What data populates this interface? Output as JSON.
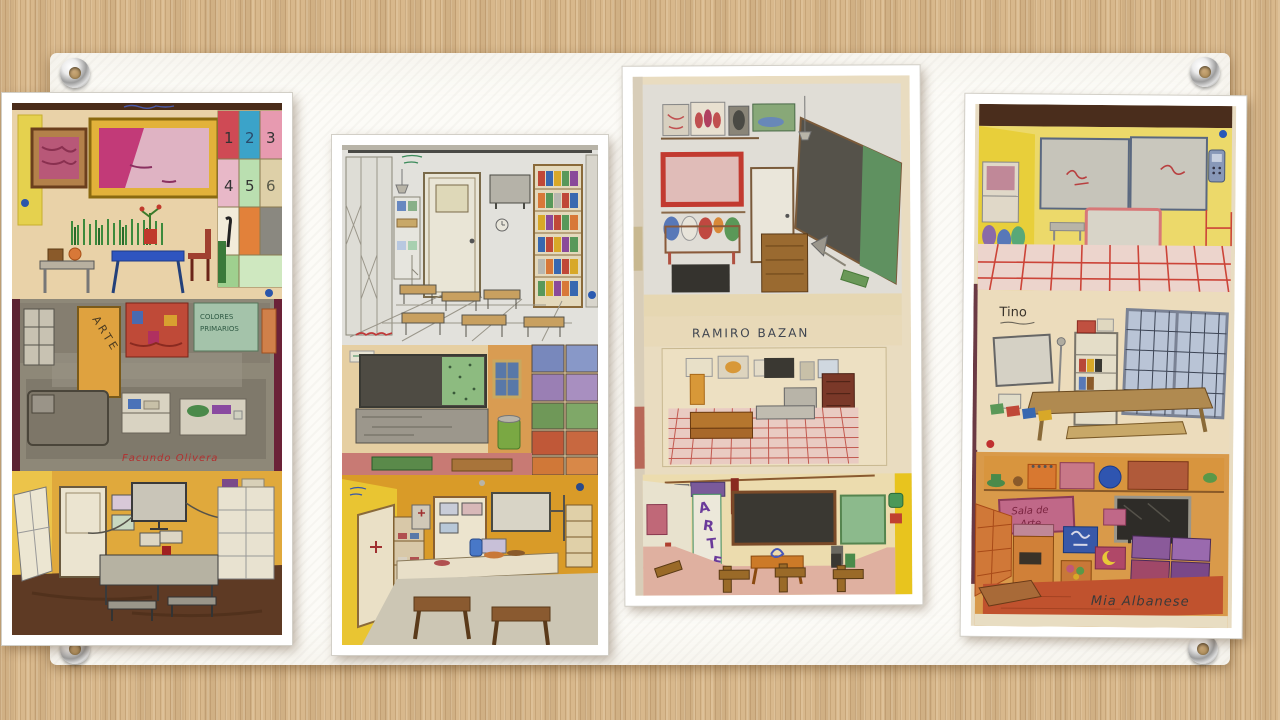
{
  "slide": {
    "type": "presentation-slide-with-pinned-photos",
    "photo_count": 4
  },
  "palette": {
    "background_stripe_tan": "#d8b88c",
    "panel_white": "#fcfbf7",
    "photo_border_white": "#ffffff",
    "grommet_metal": "#b5b5b5",
    "grommet_hole_tan": "#b8945e",
    "signature_red": "#b23030",
    "name_ink_dark": "#3f4550",
    "arte_purple": "#6a3a9a",
    "blackboard_dark": "#3a3832",
    "greenboard": "#8cba8c"
  },
  "texts": {
    "photo1": {
      "grid_numbers": [
        "1",
        "2",
        "3",
        "4",
        "5",
        "6"
      ],
      "door_label": "ARTE",
      "board_line1": "COLORES",
      "board_line2": "PRIMARIOS",
      "signature": "Facundo Olivera"
    },
    "photo3": {
      "author": "RAMIRO BAZAN",
      "arte_letters": [
        "A",
        "R",
        "T",
        "E"
      ]
    },
    "photo4": {
      "author_middle": "Tino",
      "sign_line1": "Sala de",
      "sign_line2": "Arte",
      "author_bottom": "Mia Albanese"
    }
  }
}
